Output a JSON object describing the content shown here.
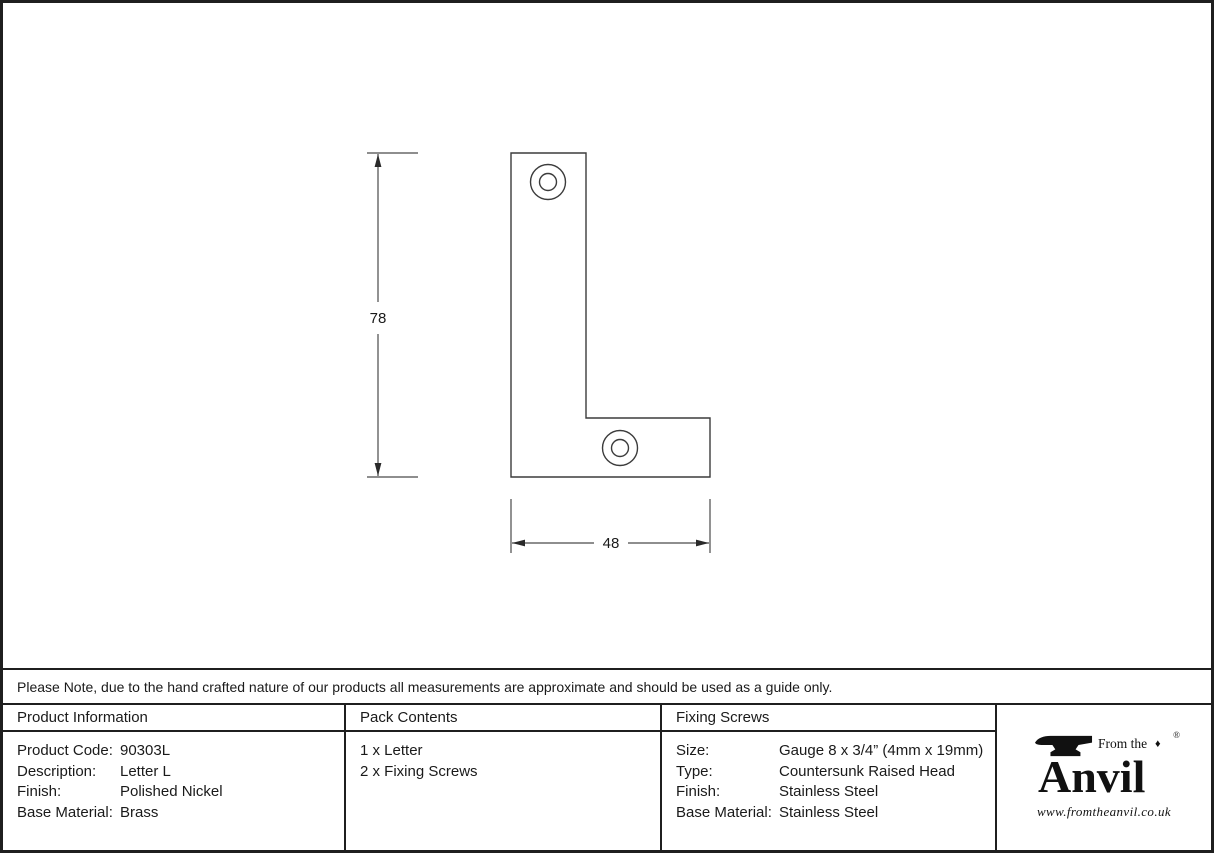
{
  "drawing": {
    "height_dimension": "78",
    "width_dimension": "48"
  },
  "note": {
    "text": "Please Note, due to the hand crafted nature of our products all measurements are approximate and should be used as a guide only."
  },
  "table": {
    "product_information": {
      "header": "Product Information",
      "rows": [
        {
          "label": "Product Code:",
          "value": "90303L"
        },
        {
          "label": "Description:",
          "value": "Letter L"
        },
        {
          "label": "Finish:",
          "value": "Polished Nickel"
        },
        {
          "label": "Base Material:",
          "value": "Brass"
        }
      ]
    },
    "pack_contents": {
      "header": "Pack Contents",
      "items": [
        "1 x Letter",
        "2 x Fixing Screws"
      ]
    },
    "fixing_screws": {
      "header": "Fixing Screws",
      "rows": [
        {
          "label": "Size:",
          "value": "Gauge 8 x 3/4” (4mm x 19mm)"
        },
        {
          "label": "Type:",
          "value": "Countersunk Raised Head"
        },
        {
          "label": "Finish:",
          "value": "Stainless Steel"
        },
        {
          "label": "Base Material:",
          "value": "Stainless Steel"
        }
      ]
    }
  },
  "logo": {
    "tagline": "From the",
    "brand": "Anvil",
    "diamond": "♦",
    "registered": "®",
    "website": "www.fromtheanvil.co.uk"
  }
}
